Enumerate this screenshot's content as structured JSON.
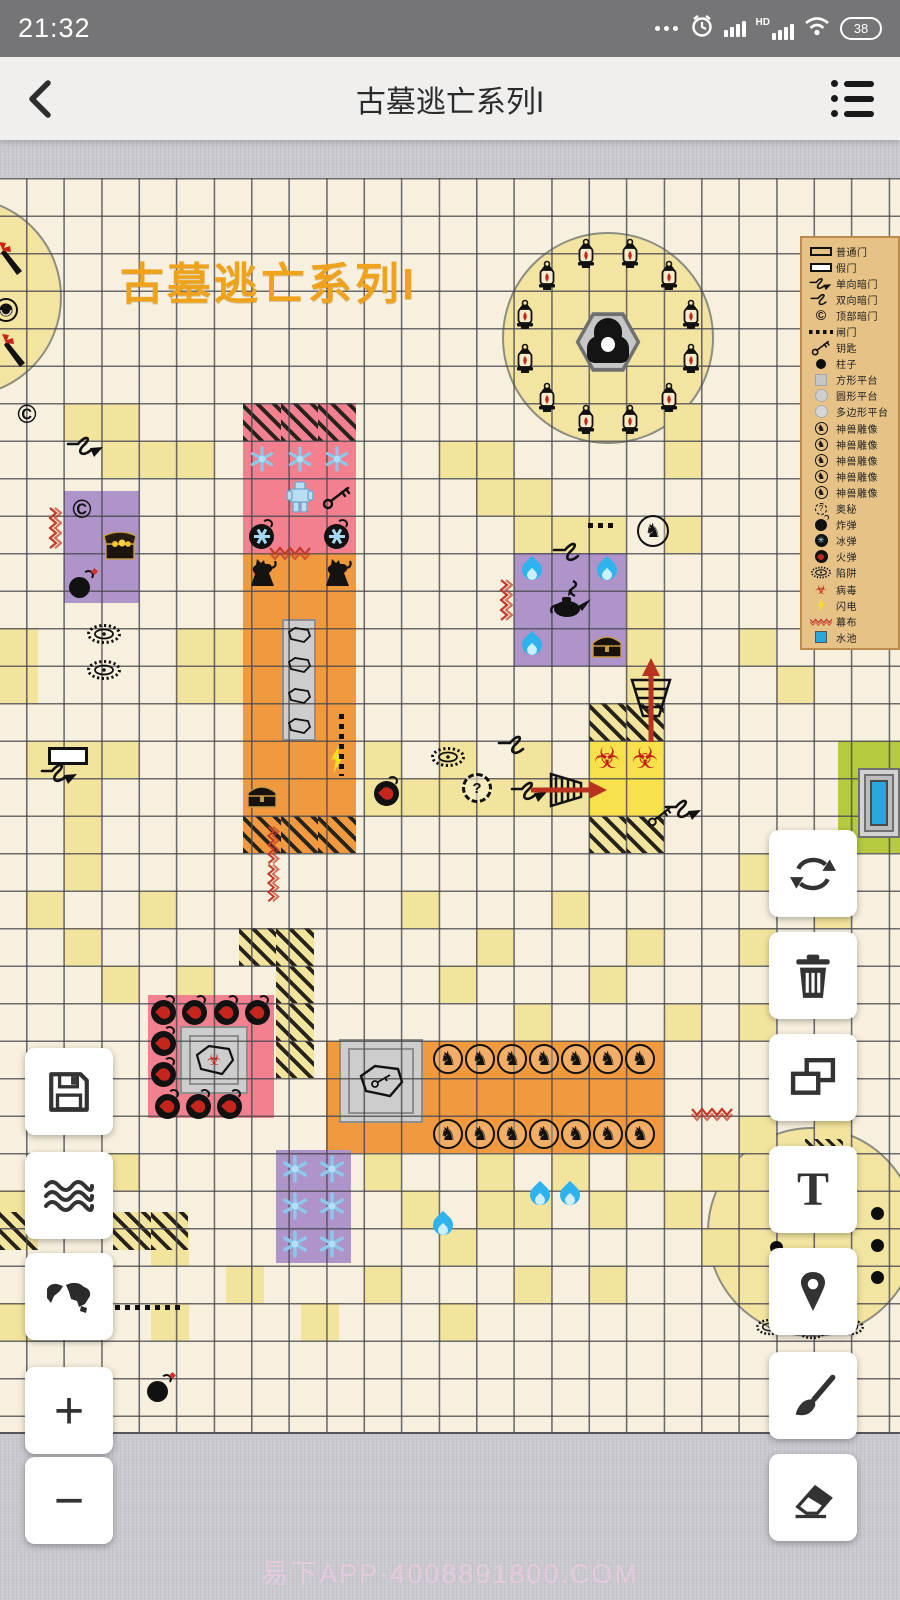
{
  "status_bar": {
    "time": "21:32",
    "battery": "38",
    "hd": "HD"
  },
  "nav_bar": {
    "title": "古墓逃亡系列I"
  },
  "canvas": {
    "map_title": {
      "text": "古墓逃亡系列I",
      "color": "#efa31d"
    },
    "watermark": {
      "text": "易下APP·4008891800.COM"
    },
    "palette": {
      "cream": "#f8f0de",
      "yellow": "#f3e49d",
      "bright_yellow": "#f9e14c",
      "pink": "#f2808f",
      "orange": "#f0993f",
      "purple": "#ae94c9",
      "green": "#b6c93f",
      "grid_line": "#55555b",
      "legend_bg": "#e7c286",
      "legend_border": "#bd8a4c",
      "accent_red": "#b8321f",
      "pool_blue": "#29a7dc"
    },
    "legend": {
      "items": [
        {
          "icon": "door-black",
          "label": "普通门"
        },
        {
          "icon": "door-white",
          "label": "假门"
        },
        {
          "icon": "squigglearrow",
          "label": "单向暗门"
        },
        {
          "icon": "squiggle",
          "label": "双向暗门"
        },
        {
          "icon": "copyright",
          "label": "顶部暗门"
        },
        {
          "icon": "dash",
          "label": "闸门"
        },
        {
          "icon": "key",
          "label": "钥匙"
        },
        {
          "icon": "pillar",
          "label": "柱子"
        },
        {
          "icon": "plat-square",
          "label": "方形平台"
        },
        {
          "icon": "plat-circle",
          "label": "圆形平台"
        },
        {
          "icon": "plat-poly",
          "label": "多边形平台"
        },
        {
          "icon": "beast",
          "label": "神兽雕像"
        },
        {
          "icon": "beast",
          "label": "神兽雕像"
        },
        {
          "icon": "beast",
          "label": "神兽雕像"
        },
        {
          "icon": "beast",
          "label": "神兽雕像"
        },
        {
          "icon": "beast",
          "label": "神兽雕像"
        },
        {
          "icon": "mystery",
          "label": "奥秘"
        },
        {
          "icon": "bomb",
          "label": "炸弹"
        },
        {
          "icon": "icebomb",
          "label": "冰弹"
        },
        {
          "icon": "firebomb",
          "label": "火弹"
        },
        {
          "icon": "trap",
          "label": "陷阱"
        },
        {
          "icon": "biohazard",
          "label": "病毒"
        },
        {
          "icon": "lightning",
          "label": "闪电"
        },
        {
          "icon": "redsquiggleh",
          "label": "幕布"
        },
        {
          "icon": "pool",
          "label": "水池"
        }
      ]
    },
    "circles": [
      {
        "cx": -38,
        "cy": 297,
        "r": 100
      },
      {
        "cx": 608,
        "cy": 338,
        "r": 106
      },
      {
        "cx": 812,
        "cy": 1232,
        "r": 105
      }
    ],
    "rooms": [
      {
        "name": "ice-room",
        "x": 243,
        "y": 440.5,
        "w": 112.5,
        "h": 112.5,
        "color": "pink"
      },
      {
        "name": "treasure-room",
        "x": 63.5,
        "y": 490.5,
        "w": 75,
        "h": 112.5,
        "color": "purple"
      },
      {
        "name": "pillar-hall",
        "x": 243,
        "y": 553,
        "w": 112.5,
        "h": 262.5,
        "color": "orange"
      },
      {
        "name": "lamp-room",
        "x": 513.5,
        "y": 553,
        "w": 112.5,
        "h": 112.5,
        "color": "purple"
      },
      {
        "name": "bomb-room",
        "x": 148,
        "y": 995,
        "w": 126,
        "h": 123,
        "color": "pink"
      },
      {
        "name": "stable-hall",
        "x": 326,
        "y": 1040.5,
        "w": 337.5,
        "h": 112.5,
        "color": "orange"
      },
      {
        "name": "snow-room",
        "x": 276,
        "y": 1150,
        "w": 75,
        "h": 112.5,
        "color": "purple"
      }
    ],
    "platforms": [
      {
        "type": "strip",
        "x": 282,
        "y": 619,
        "w": 34,
        "h": 122
      },
      {
        "type": "nested",
        "x": 339,
        "y": 1039,
        "w": 84,
        "h": 84
      },
      {
        "type": "nested",
        "x": 180,
        "y": 1026,
        "w": 68,
        "h": 68
      }
    ],
    "tiles": {
      "yellow": [
        [
          63.5,
          403
        ],
        [
          101,
          403
        ],
        [
          101,
          440.5
        ],
        [
          138.5,
          440.5
        ],
        [
          176,
          440.5
        ],
        [
          438.5,
          440.5
        ],
        [
          476,
          440.5
        ],
        [
          476,
          478
        ],
        [
          513.5,
          478
        ],
        [
          513.5,
          515.5
        ],
        [
          551,
          515.5
        ],
        [
          588.5,
          515.5
        ],
        [
          663.5,
          403
        ],
        [
          663.5,
          440.5
        ],
        [
          663.5,
          515.5
        ],
        [
          626,
          590.5
        ],
        [
          626,
          628
        ],
        [
          626,
          665.5
        ],
        [
          0,
          628
        ],
        [
          0,
          665.5
        ],
        [
          176,
          628
        ],
        [
          213.5,
          628
        ],
        [
          176,
          665.5
        ],
        [
          213.5,
          665.5
        ],
        [
          26,
          740.5
        ],
        [
          63.5,
          740.5
        ],
        [
          101,
          740.5
        ],
        [
          63.5,
          778
        ],
        [
          63.5,
          815.5
        ],
        [
          363.5,
          740.5
        ],
        [
          438.5,
          740.5
        ],
        [
          513.5,
          740.5
        ],
        [
          363.5,
          778
        ],
        [
          401,
          778
        ],
        [
          438.5,
          778
        ],
        [
          476,
          778
        ],
        [
          513.5,
          778
        ],
        [
          551,
          778
        ],
        [
          738.5,
          628
        ],
        [
          776,
          665.5
        ],
        [
          63.5,
          853
        ],
        [
          26,
          890.5
        ],
        [
          138.5,
          890.5
        ],
        [
          63.5,
          928
        ],
        [
          101,
          965.5
        ],
        [
          176,
          965.5
        ],
        [
          401,
          890.5
        ],
        [
          551,
          890.5
        ],
        [
          476,
          928
        ],
        [
          626,
          928
        ],
        [
          438.5,
          965.5
        ],
        [
          588.5,
          965.5
        ],
        [
          513.5,
          1003
        ],
        [
          663.5,
          1003
        ],
        [
          738.5,
          853
        ],
        [
          776,
          853
        ],
        [
          813.5,
          890.5
        ],
        [
          738.5,
          928
        ],
        [
          776,
          965.5
        ],
        [
          738.5,
          1003
        ],
        [
          738.5,
          1115.5
        ],
        [
          813.5,
          1115.5
        ],
        [
          26,
          1153
        ],
        [
          101,
          1153
        ],
        [
          0,
          1190
        ],
        [
          151,
          1228
        ],
        [
          63.5,
          1265.5
        ],
        [
          0,
          1303
        ],
        [
          151,
          1303
        ],
        [
          226,
          1265.5
        ],
        [
          301,
          1303
        ],
        [
          363.5,
          1153
        ],
        [
          476,
          1153
        ],
        [
          551,
          1153
        ],
        [
          626,
          1153
        ],
        [
          701,
          1153
        ],
        [
          401,
          1190
        ],
        [
          476,
          1190
        ],
        [
          513.5,
          1190
        ],
        [
          588.5,
          1190
        ],
        [
          663.5,
          1190
        ],
        [
          701,
          1228
        ],
        [
          438.5,
          1228
        ],
        [
          363.5,
          1265.5
        ],
        [
          513.5,
          1265.5
        ],
        [
          588.5,
          1265.5
        ],
        [
          438.5,
          1303
        ]
      ],
      "bright": [
        [
          588.5,
          740.5
        ],
        [
          626,
          740.5
        ],
        [
          588.5,
          778
        ],
        [
          626,
          778
        ]
      ],
      "green": [
        [
          838,
          740.5
        ],
        [
          875.5,
          740.5
        ],
        [
          838,
          778
        ],
        [
          838,
          815.5
        ],
        [
          875.5,
          815.5
        ]
      ],
      "hatched_pink": [
        [
          243,
          403
        ],
        [
          280.5,
          403
        ],
        [
          318,
          403
        ]
      ],
      "hatched_orange": [
        [
          243,
          815.5
        ],
        [
          280.5,
          815.5
        ],
        [
          318,
          815.5
        ]
      ],
      "hatched_yellow": [
        [
          588.5,
          703
        ],
        [
          626,
          703
        ],
        [
          588.5,
          815.5
        ],
        [
          626,
          815.5
        ],
        [
          238.5,
          928
        ],
        [
          276,
          928
        ],
        [
          276,
          965.5
        ],
        [
          276,
          1003
        ],
        [
          276,
          1040.5
        ],
        [
          0,
          1212
        ],
        [
          113,
          1212
        ],
        [
          150.5,
          1212
        ],
        [
          813.5,
          1040.5
        ]
      ]
    },
    "lantern_ring": {
      "cx": 608,
      "cy": 338,
      "r": 86,
      "count": 12,
      "start_deg": -105,
      "step_deg": 30
    },
    "stable_horses": {
      "x_start": 448,
      "step": 32,
      "count": 7,
      "rows": [
        1059,
        1134
      ],
      "size": 30
    },
    "icons": [
      [
        "torch",
        12,
        258,
        30,
        36
      ],
      [
        "torch",
        15,
        350,
        30,
        36
      ],
      [
        "statue",
        6,
        310,
        26,
        26
      ],
      [
        "copyright",
        27,
        414,
        30,
        30
      ],
      [
        "copyright",
        82,
        509,
        30,
        30
      ],
      [
        "squigglearrow",
        86,
        445,
        40,
        30
      ],
      [
        "squigglearrow",
        60,
        772,
        40,
        30
      ],
      [
        "squigglearrow",
        530,
        790,
        40,
        30
      ],
      [
        "squigglearrow",
        684,
        808,
        40,
        30
      ],
      [
        "squiggle",
        570,
        551,
        36,
        26
      ],
      [
        "squiggle",
        515,
        744,
        36,
        26
      ],
      [
        "key",
        337,
        496.5,
        30,
        26
      ],
      [
        "key",
        660,
        816,
        26,
        22
      ],
      [
        "trap",
        104,
        634,
        36,
        22
      ],
      [
        "trap",
        104,
        670,
        36,
        22
      ],
      [
        "trap",
        448,
        757,
        36,
        22
      ],
      [
        "trap",
        770,
        1327,
        30,
        18
      ],
      [
        "trap",
        812,
        1331,
        30,
        18
      ],
      [
        "trap",
        850,
        1327,
        30,
        18
      ],
      [
        "mystery",
        477,
        788,
        30,
        30
      ],
      [
        "bomb",
        82,
        584,
        30,
        30
      ],
      [
        "bomb",
        160,
        1388,
        30,
        30
      ],
      [
        "firebomb",
        387,
        791,
        32,
        32
      ],
      [
        "firebomb",
        164,
        1010,
        32,
        32
      ],
      [
        "firebomb",
        195,
        1010,
        32,
        32
      ],
      [
        "firebomb",
        227,
        1010,
        32,
        32
      ],
      [
        "firebomb",
        258,
        1010,
        32,
        32
      ],
      [
        "firebomb",
        164,
        1041,
        32,
        32
      ],
      [
        "firebomb",
        164,
        1072,
        32,
        32
      ],
      [
        "firebomb",
        168,
        1104,
        32,
        32
      ],
      [
        "firebomb",
        199,
        1104,
        32,
        32
      ],
      [
        "firebomb",
        230,
        1104,
        32,
        32
      ],
      [
        "chestopen",
        120,
        546.5,
        36,
        30
      ],
      [
        "chest",
        262,
        797,
        34,
        28
      ],
      [
        "chest",
        607,
        647,
        34,
        28
      ],
      [
        "lightning",
        337,
        759,
        18,
        28
      ],
      [
        "snowflake",
        262,
        459,
        26,
        26
      ],
      [
        "snowflake",
        299.5,
        459,
        26,
        26
      ],
      [
        "snowflake",
        337,
        459,
        26,
        26
      ],
      [
        "snowflake",
        294.7,
        1168.7,
        28,
        28
      ],
      [
        "snowflake",
        332.2,
        1168.7,
        28,
        28
      ],
      [
        "snowflake",
        294.7,
        1206.2,
        28,
        28
      ],
      [
        "snowflake",
        332.2,
        1206.2,
        28,
        28
      ],
      [
        "snowflake",
        294.7,
        1243.7,
        28,
        28
      ],
      [
        "snowflake",
        332.2,
        1243.7,
        28,
        28
      ],
      [
        "golem",
        299.5,
        497,
        30,
        34
      ],
      [
        "icebomb",
        262,
        534,
        32,
        32
      ],
      [
        "icebomb",
        337,
        534,
        32,
        32
      ],
      [
        "lion",
        262,
        571.5,
        30,
        32
      ],
      [
        "lion",
        337,
        571.5,
        30,
        32
      ],
      [
        "coffin",
        299,
        634.5,
        26,
        18
      ],
      [
        "coffin",
        299,
        665,
        26,
        18
      ],
      [
        "coffin",
        299,
        695.5,
        26,
        18
      ],
      [
        "coffin",
        299,
        726,
        26,
        18
      ],
      [
        "coffinbio",
        214,
        1060,
        46,
        38
      ],
      [
        "coffinkey",
        381,
        1081,
        54,
        42
      ],
      [
        "horsecircle",
        653,
        531,
        32,
        32
      ],
      [
        "reaper",
        608,
        342,
        66,
        62
      ],
      [
        "genie",
        570,
        600,
        46,
        42
      ],
      [
        "blueflame",
        532,
        572,
        24,
        30
      ],
      [
        "blueflame",
        607,
        572,
        24,
        30
      ],
      [
        "blueflame",
        532,
        647,
        24,
        30
      ],
      [
        "blueflame",
        540,
        1197,
        24,
        30
      ],
      [
        "blueflame",
        570,
        1197,
        24,
        30
      ],
      [
        "blueflame",
        443,
        1227,
        24,
        30
      ],
      [
        "biohazard",
        607,
        759,
        30,
        30
      ],
      [
        "biohazard",
        645,
        759,
        30,
        30
      ],
      [
        "redsquigglev",
        54,
        528,
        16,
        44
      ],
      [
        "redsquigglev",
        505,
        600,
        16,
        44
      ],
      [
        "redsquigglev",
        272,
        845,
        16,
        40
      ],
      [
        "redsquigglev",
        272,
        883,
        16,
        40
      ],
      [
        "redsquiggleh",
        290,
        552,
        44,
        16
      ],
      [
        "redsquiggleh",
        712,
        1113,
        44,
        16
      ],
      [
        "dashh",
        603,
        525,
        30,
        5
      ],
      [
        "dashh",
        148,
        1307,
        66,
        5
      ],
      [
        "dashv",
        341,
        745,
        5,
        62
      ],
      [
        "whitedoor",
        68,
        756,
        40,
        18
      ],
      [
        "pool",
        879,
        803,
        42,
        70
      ],
      [
        "arrowup",
        651,
        700,
        46,
        88
      ],
      [
        "arrowright",
        569,
        790,
        80,
        40
      ],
      [
        "hatchstrip",
        824,
        1146,
        38,
        14
      ],
      [
        "pillar",
        776,
        1183,
        13,
        13
      ],
      [
        "pillar",
        776,
        1215,
        13,
        13
      ],
      [
        "pillar",
        776,
        1247,
        13,
        13
      ],
      [
        "pillar",
        776,
        1279,
        13,
        13
      ],
      [
        "pillar",
        877,
        1213,
        13,
        13
      ],
      [
        "pillar",
        877,
        1245,
        13,
        13
      ],
      [
        "pillar",
        877,
        1277,
        13,
        13
      ]
    ],
    "toolbars": {
      "left": [
        {
          "name": "save",
          "y": 1048
        },
        {
          "name": "water",
          "y": 1152
        },
        {
          "name": "world-map",
          "y": 1253
        },
        {
          "name": "zoom-in",
          "y": 1367,
          "glyph": "+"
        },
        {
          "name": "zoom-out",
          "y": 1457,
          "glyph": "−"
        }
      ],
      "right": [
        {
          "name": "rotate",
          "y": 830
        },
        {
          "name": "delete",
          "y": 932
        },
        {
          "name": "copy",
          "y": 1034
        },
        {
          "name": "text",
          "y": 1146,
          "glyph": "T"
        },
        {
          "name": "location",
          "y": 1248
        },
        {
          "name": "brush",
          "y": 1352
        },
        {
          "name": "eraser",
          "y": 1454
        }
      ]
    }
  }
}
